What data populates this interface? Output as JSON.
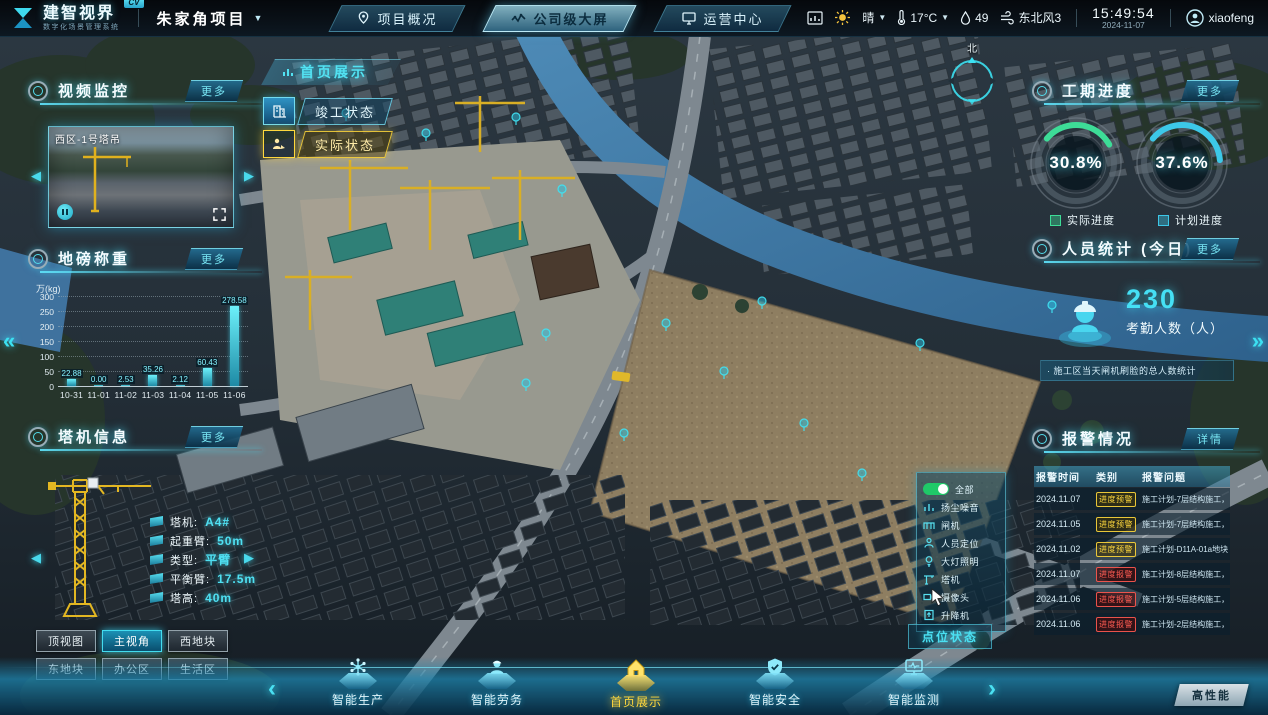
{
  "colors": {
    "accent": "#3ce1f2",
    "green": "#3ddc97",
    "yellow": "#ffd83d",
    "red": "#ff5b52",
    "toggle_on": "#1fc968"
  },
  "header": {
    "logo_title": "建智视界",
    "logo_badge": "CV",
    "logo_subtitle": "数字化场景管理系统",
    "project_name": "朱家角项目",
    "project_caret": "▼",
    "tabs": [
      {
        "label": "项目概况",
        "active": false
      },
      {
        "label": "公司级大屏",
        "active": true
      },
      {
        "label": "运营中心",
        "active": false
      }
    ],
    "weather": {
      "condition": "晴",
      "temperature": "17°C",
      "humidity": "49",
      "wind": "东北风3"
    },
    "time": "15:49:54",
    "date": "2024-11-07",
    "username": "xiaofeng"
  },
  "map": {
    "breadcrumb": "首页展示",
    "compass_label": "北",
    "status_buttons": [
      {
        "label": "竣工状态"
      },
      {
        "label": "实际状态"
      }
    ],
    "performance_label": "高性能"
  },
  "video_panel": {
    "title": "视频监控",
    "more_label": "更多",
    "camera_label": "西区-1号塔吊"
  },
  "weighbridge_panel": {
    "title": "地磅称重",
    "more_label": "更多"
  },
  "chart_data": {
    "type": "bar",
    "title": "地磅称重",
    "ylabel": "万(kg)",
    "xlabel": "",
    "categories": [
      "10-31",
      "11-01",
      "11-02",
      "11-03",
      "11-04",
      "11-05",
      "11-06"
    ],
    "values": [
      22.88,
      0.0,
      2.53,
      35.26,
      2.12,
      60.43,
      278.58
    ],
    "value_labels": [
      "22.88",
      "0.00",
      "2.53",
      "35.26",
      "2.12",
      "60.43",
      "278.58"
    ],
    "ylim": [
      0,
      300
    ],
    "ytick_labels": [
      300,
      250,
      200,
      150,
      100,
      50,
      0
    ],
    "grid": "dotted",
    "legend_position": "none",
    "bar_color": "#3ce1f2"
  },
  "crane_panel": {
    "title": "塔机信息",
    "more_label": "更多",
    "fields": [
      {
        "label": "塔机:",
        "value": "A4#"
      },
      {
        "label": "起重臂:",
        "value": "50m"
      },
      {
        "label": "类型:",
        "value": "平臂"
      },
      {
        "label": "平衡臂:",
        "value": "17.5m"
      },
      {
        "label": "塔高:",
        "value": "40m"
      }
    ]
  },
  "view_buttons": [
    {
      "label": "顶视图",
      "active": false
    },
    {
      "label": "主视角",
      "active": true
    },
    {
      "label": "西地块",
      "active": false
    },
    {
      "label": "东地块",
      "active": false
    },
    {
      "label": "办公区",
      "active": false
    },
    {
      "label": "生活区",
      "active": false
    }
  ],
  "progress_panel": {
    "title": "工期进度",
    "more_label": "更多",
    "rings": [
      {
        "value": "30.8%",
        "percent": 30.8,
        "label": "实际进度",
        "color": "#3ddc97"
      },
      {
        "value": "37.6%",
        "percent": 37.6,
        "label": "计划进度",
        "color": "#3cc8e8"
      }
    ]
  },
  "staff_panel": {
    "title": "人员统计 (今日)",
    "more_label": "更多",
    "count": "230",
    "count_label": "考勤人数（人）",
    "note": "· 施工区当天闸机刷脸的总人数统计"
  },
  "alarm_panel": {
    "title": "报警情况",
    "detail_label": "详情",
    "columns": [
      "报警时间",
      "类别",
      "报警问题"
    ],
    "rows": [
      {
        "time": "2024.11.07",
        "type": "进度预警",
        "level": "warning",
        "issue": "施工计划-7层结构施工，未开始"
      },
      {
        "time": "2024.11.05",
        "type": "进度预警",
        "level": "warning",
        "issue": "施工计划-7层结构施工，未开始"
      },
      {
        "time": "2024.11.02",
        "type": "进度预警",
        "level": "warning",
        "issue": "施工计划-D11A-01a地块A05#…"
      },
      {
        "time": "2024.11.07",
        "type": "进度报警",
        "level": "alarm",
        "issue": "施工计划-8层结构施工，未完成"
      },
      {
        "time": "2024.11.06",
        "type": "进度报警",
        "level": "alarm",
        "issue": "施工计划-5层结构施工，未完成"
      },
      {
        "time": "2024.11.06",
        "type": "进度报警",
        "level": "alarm",
        "issue": "施工计划-2层结构施工，未完成"
      }
    ]
  },
  "legend_panel": {
    "all_label": "全部",
    "items": [
      "扬尘噪音",
      "闸机",
      "人员定位",
      "大灯照明",
      "塔机",
      "摄像头",
      "升降机"
    ],
    "button_label": "点位状态"
  },
  "bottom_nav": {
    "items": [
      {
        "label": "智能生产",
        "active": false
      },
      {
        "label": "智能劳务",
        "active": false
      },
      {
        "label": "首页展示",
        "active": true
      },
      {
        "label": "智能安全",
        "active": false
      },
      {
        "label": "智能监测",
        "active": false
      }
    ]
  }
}
